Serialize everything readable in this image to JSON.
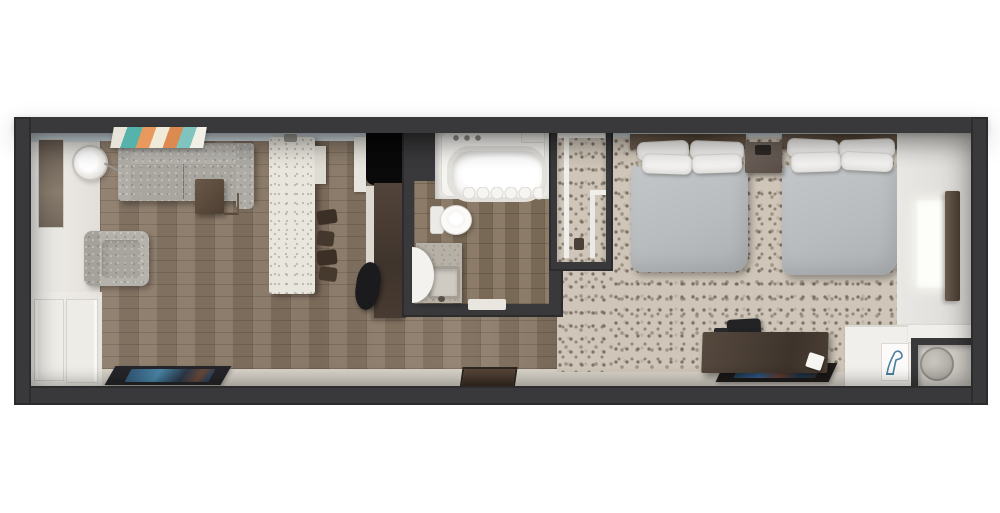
{
  "page": {
    "title": "3D top-down floor plan rendering of a studio hotel suite",
    "background": "#ffffff"
  },
  "palette": {
    "wall_dark": "#39383a",
    "wall_darker": "#2c2b2d",
    "ceiling_blue": "#ccd8dd",
    "wall_white": "#efede8",
    "wood": "#8b7a69",
    "tile": "#84735f",
    "carpet": "#cfc6b9",
    "hallway_floor": "#ddd8cf",
    "sofa": "#a9a6a0",
    "bed": "#b9bcbe",
    "pillow": "#f4f3f1",
    "wood_brown": "#4e4137",
    "wood_brown_light": "#6f635a",
    "island": "#e9e6de",
    "tv": "#0a0a0a",
    "teal": "#56b3ab",
    "orange": "#dd8a50",
    "rug_blue": "#3a6ea5",
    "vanity": "#b6b0a6",
    "fixture_white": "#f5f4f1"
  },
  "scene": {
    "rooms": [
      {
        "id": "living",
        "label": "Living and kitchenette area"
      },
      {
        "id": "bathroom",
        "label": "Bathroom"
      },
      {
        "id": "closet",
        "label": "Closet with wire shelving"
      },
      {
        "id": "bedroom",
        "label": "Bedroom with two beds"
      },
      {
        "id": "hallway",
        "label": "Entry hallway"
      }
    ],
    "furniture": {
      "sofa": "Gray sectional sofa",
      "side_table": "Wood side table",
      "armchair": "Gray armchair",
      "floor_lamp": "Floor lamp",
      "mirror": "Full-length mirror",
      "artwork": "Abstract wall art",
      "entry_door": "Entry door panels",
      "kitchen_island": "Kitchen island counter",
      "bar_stools": "Bar stools",
      "tv": "Flat-screen TV",
      "media_console": "Media console",
      "console_chair": "Console chair",
      "bathtub": "Bathtub with shower",
      "toilet": "Toilet",
      "vanity_sink": "Vanity with sink",
      "bathroom_door": "Bathroom door swing",
      "closet_shelves": "Closet shelving",
      "bed_1": "Bed 1 with pillows",
      "bed_2": "Bed 2 with pillows",
      "nightstand": "Nightstand",
      "desk": "Work desk",
      "desk_chair": "Desk chair",
      "desk_rug": "Rug under desk",
      "window": "Bedroom window",
      "curtain": "Curtain panel",
      "luggage_counter": "Luggage counter",
      "shoe_art": "Blue shoe artwork",
      "mini_fridge": "Mini fridge nook",
      "door_mat_living": "Entry door mat",
      "door_mat_center": "Hallway mat"
    }
  }
}
